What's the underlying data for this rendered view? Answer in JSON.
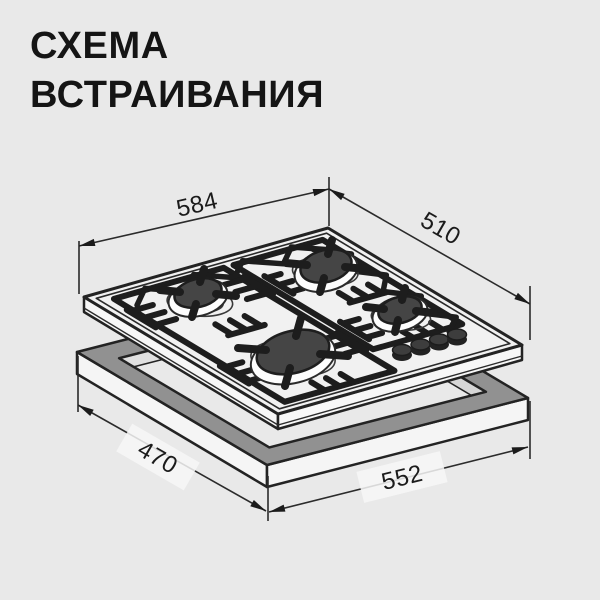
{
  "title": {
    "line1": "СХЕМА",
    "line2": "ВСТРАИВАНИЯ"
  },
  "dimensions": {
    "hob_width_mm": "584",
    "hob_depth_mm": "510",
    "cutout_depth_mm": "470",
    "cutout_width_mm": "552"
  },
  "diagram": {
    "subject": "built-in gas hob installation scheme",
    "burner_count": 4,
    "knob_count": 4
  },
  "colors": {
    "background": "#e9e9e9",
    "line_art": "#1d1d1d",
    "cutout_top_face": "#919191",
    "burner_cap": "#454545"
  }
}
